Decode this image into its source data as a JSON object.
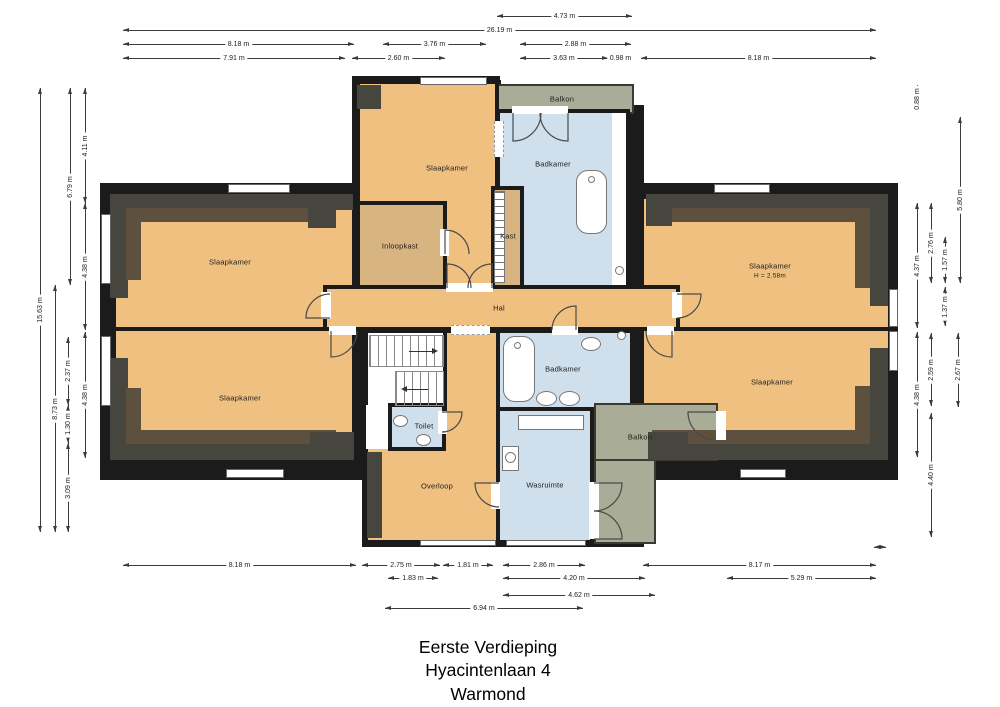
{
  "meta": {
    "width": 1000,
    "height": 707,
    "background": "#ffffff"
  },
  "title": {
    "line1": "Eerste Verdieping",
    "line2": "Hyacintenlaan 4",
    "line3": "Warmond"
  },
  "palette": {
    "wall": "#1b1b1b",
    "room": "#f0c080",
    "closet": "#d8b481",
    "wet": "#cfdfec",
    "balcony": "#a9ac97",
    "white": "#ffffff",
    "slope_dark": "#46463f",
    "slope_brown": "#5d503e",
    "dim_line": "#3c3c3c",
    "label": "#1d1d1d"
  },
  "walls": [
    {
      "x": 100,
      "y": 183,
      "w": 265,
      "h": 297
    },
    {
      "x": 352,
      "y": 76,
      "w": 148,
      "h": 110
    },
    {
      "x": 492,
      "y": 105,
      "w": 152,
      "h": 81
    },
    {
      "x": 488,
      "y": 76,
      "w": 12,
      "h": 34
    },
    {
      "x": 362,
      "y": 180,
      "w": 282,
      "h": 367
    },
    {
      "x": 636,
      "y": 183,
      "w": 262,
      "h": 297
    },
    {
      "x": 493,
      "y": 80,
      "w": 8,
      "h": 110
    },
    {
      "x": 606,
      "y": 235,
      "w": 7,
      "h": 52
    },
    {
      "x": 716,
      "y": 403,
      "w": 10,
      "h": 76
    }
  ],
  "rooms": [
    {
      "name": "balkon-top",
      "fill": "balcony",
      "x": 490,
      "y": 84,
      "w": 144,
      "h": 30,
      "border": "thin"
    },
    {
      "name": "slaapkamer-top-left",
      "fill": "room",
      "x": 112,
      "y": 195,
      "w": 244,
      "h": 136,
      "border": "thick"
    },
    {
      "name": "slaapkamer-bottom-left",
      "fill": "room",
      "x": 112,
      "y": 327,
      "w": 244,
      "h": 135,
      "border": "thick"
    },
    {
      "name": "slaapkamer-top-right",
      "fill": "room",
      "x": 640,
      "y": 195,
      "w": 252,
      "h": 136,
      "border": "thick"
    },
    {
      "name": "slaapkamer-bottom-right",
      "fill": "room",
      "x": 640,
      "y": 327,
      "w": 252,
      "h": 135,
      "border": "thick"
    },
    {
      "name": "slaapkamer-top-center",
      "fill": "room",
      "x": 356,
      "y": 80,
      "w": 143,
      "h": 211,
      "border": "thick"
    },
    {
      "name": "badkamer-top",
      "fill": "wet",
      "x": 496,
      "y": 109,
      "w": 134,
      "h": 182,
      "border": "thick"
    },
    {
      "name": "douche-strip",
      "fill": "white",
      "x": 612,
      "y": 113,
      "w": 14,
      "h": 174,
      "border": "none"
    },
    {
      "name": "inloopkast",
      "fill": "closet",
      "x": 356,
      "y": 201,
      "w": 91,
      "h": 90,
      "border": "thick"
    },
    {
      "name": "kast",
      "fill": "closet",
      "x": 491,
      "y": 186,
      "w": 33,
      "h": 105,
      "border": "thick"
    },
    {
      "name": "hal",
      "fill": "room",
      "x": 323,
      "y": 285,
      "w": 357,
      "h": 46,
      "border": "thick"
    },
    {
      "name": "overloop",
      "fill": "room",
      "x": 364,
      "y": 329,
      "w": 137,
      "h": 215,
      "border": "thick"
    },
    {
      "name": "stairwell",
      "fill": "white",
      "x": 364,
      "y": 329,
      "w": 83,
      "h": 82,
      "border": "thick"
    },
    {
      "name": "stair-landing",
      "fill": "white",
      "x": 366,
      "y": 405,
      "w": 24,
      "h": 44,
      "border": "none"
    },
    {
      "name": "toilet",
      "fill": "wet",
      "x": 388,
      "y": 403,
      "w": 58,
      "h": 48,
      "border": "thick"
    },
    {
      "name": "badkamer-bottom",
      "fill": "wet",
      "x": 496,
      "y": 329,
      "w": 138,
      "h": 86,
      "border": "thick"
    },
    {
      "name": "wasruimte",
      "fill": "wet",
      "x": 496,
      "y": 407,
      "w": 98,
      "h": 137,
      "border": "thick"
    },
    {
      "name": "balkon-bottom-vertical",
      "fill": "balcony",
      "x": 594,
      "y": 403,
      "w": 62,
      "h": 141,
      "border": "thin"
    },
    {
      "name": "balkon-bottom-horizontal",
      "fill": "balcony",
      "x": 594,
      "y": 403,
      "w": 124,
      "h": 58,
      "border": "thin"
    }
  ],
  "slopes": [
    {
      "x": 110,
      "y": 194,
      "w": 243,
      "h": 16,
      "tone": "dark"
    },
    {
      "x": 110,
      "y": 194,
      "w": 18,
      "h": 104,
      "tone": "dark"
    },
    {
      "x": 126,
      "y": 208,
      "w": 210,
      "h": 14,
      "tone": "brown"
    },
    {
      "x": 126,
      "y": 208,
      "w": 15,
      "h": 72,
      "tone": "brown"
    },
    {
      "x": 308,
      "y": 194,
      "w": 28,
      "h": 34,
      "tone": "dark"
    },
    {
      "x": 646,
      "y": 194,
      "w": 242,
      "h": 16,
      "tone": "dark"
    },
    {
      "x": 870,
      "y": 194,
      "w": 18,
      "h": 112,
      "tone": "dark"
    },
    {
      "x": 652,
      "y": 208,
      "w": 218,
      "h": 14,
      "tone": "brown"
    },
    {
      "x": 855,
      "y": 208,
      "w": 15,
      "h": 80,
      "tone": "brown"
    },
    {
      "x": 646,
      "y": 194,
      "w": 26,
      "h": 32,
      "tone": "dark"
    },
    {
      "x": 110,
      "y": 444,
      "w": 243,
      "h": 16,
      "tone": "dark"
    },
    {
      "x": 110,
      "y": 358,
      "w": 18,
      "h": 102,
      "tone": "dark"
    },
    {
      "x": 126,
      "y": 430,
      "w": 210,
      "h": 14,
      "tone": "brown"
    },
    {
      "x": 126,
      "y": 388,
      "w": 15,
      "h": 42,
      "tone": "brown"
    },
    {
      "x": 310,
      "y": 432,
      "w": 44,
      "h": 28,
      "tone": "dark"
    },
    {
      "x": 648,
      "y": 444,
      "w": 240,
      "h": 16,
      "tone": "dark"
    },
    {
      "x": 870,
      "y": 348,
      "w": 18,
      "h": 112,
      "tone": "dark"
    },
    {
      "x": 652,
      "y": 430,
      "w": 218,
      "h": 14,
      "tone": "brown"
    },
    {
      "x": 855,
      "y": 386,
      "w": 15,
      "h": 44,
      "tone": "brown"
    },
    {
      "x": 648,
      "y": 432,
      "w": 40,
      "h": 28,
      "tone": "dark"
    },
    {
      "x": 357,
      "y": 85,
      "w": 24,
      "h": 24,
      "tone": "dark"
    },
    {
      "x": 367,
      "y": 452,
      "w": 15,
      "h": 86,
      "tone": "dark"
    }
  ],
  "windows": [
    {
      "x": 228,
      "y": 184,
      "w": 62,
      "h": 9
    },
    {
      "x": 420,
      "y": 77,
      "w": 67,
      "h": 8
    },
    {
      "x": 714,
      "y": 184,
      "w": 56,
      "h": 9
    },
    {
      "x": 101,
      "y": 214,
      "w": 10,
      "h": 70
    },
    {
      "x": 101,
      "y": 336,
      "w": 10,
      "h": 70
    },
    {
      "x": 889,
      "y": 289,
      "w": 9,
      "h": 38
    },
    {
      "x": 889,
      "y": 331,
      "w": 9,
      "h": 40
    },
    {
      "x": 226,
      "y": 469,
      "w": 58,
      "h": 9
    },
    {
      "x": 740,
      "y": 469,
      "w": 46,
      "h": 9
    },
    {
      "x": 420,
      "y": 540,
      "w": 76,
      "h": 6
    },
    {
      "x": 506,
      "y": 540,
      "w": 80,
      "h": 6
    }
  ],
  "gaps": [
    {
      "x": 321,
      "y": 292,
      "w": 10,
      "h": 27
    },
    {
      "x": 329,
      "y": 326,
      "w": 27,
      "h": 9
    },
    {
      "x": 672,
      "y": 292,
      "w": 10,
      "h": 26
    },
    {
      "x": 647,
      "y": 326,
      "w": 27,
      "h": 9
    },
    {
      "x": 552,
      "y": 326,
      "w": 26,
      "h": 9
    },
    {
      "x": 438,
      "y": 411,
      "w": 9,
      "h": 23
    },
    {
      "x": 491,
      "y": 482,
      "w": 9,
      "h": 27
    },
    {
      "x": 716,
      "y": 411,
      "w": 10,
      "h": 29
    },
    {
      "x": 589,
      "y": 482,
      "w": 10,
      "h": 57
    },
    {
      "x": 440,
      "y": 229,
      "w": 9,
      "h": 27
    },
    {
      "x": 512,
      "y": 106,
      "w": 56,
      "h": 8
    },
    {
      "x": 446,
      "y": 283,
      "w": 47,
      "h": 9
    }
  ],
  "dashes": [
    {
      "x": 451,
      "y": 325,
      "w": 39,
      "h": 10,
      "o": "h"
    },
    {
      "x": 494,
      "y": 121,
      "w": 10,
      "h": 36,
      "o": "v"
    }
  ],
  "ladder": {
    "x": 494,
    "y": 191,
    "w": 11,
    "h": 92
  },
  "stairs": [
    {
      "x": 370,
      "y": 336,
      "w": 73,
      "h": 30,
      "dir": "right"
    },
    {
      "x": 396,
      "y": 372,
      "w": 47,
      "h": 33,
      "dir": "left"
    }
  ],
  "fixtures": [
    {
      "kind": "tub",
      "x": 576,
      "y": 170,
      "w": 31,
      "h": 64
    },
    {
      "kind": "circle",
      "x": 588,
      "y": 176,
      "w": 7,
      "h": 7
    },
    {
      "kind": "tub",
      "x": 503,
      "y": 336,
      "w": 32,
      "h": 66
    },
    {
      "kind": "circle",
      "x": 514,
      "y": 342,
      "w": 7,
      "h": 7
    },
    {
      "kind": "ellipse",
      "x": 536,
      "y": 391,
      "w": 21,
      "h": 15
    },
    {
      "kind": "ellipse",
      "x": 559,
      "y": 391,
      "w": 21,
      "h": 15
    },
    {
      "kind": "ellipse",
      "x": 581,
      "y": 337,
      "w": 20,
      "h": 14
    },
    {
      "kind": "ellipse",
      "x": 393,
      "y": 415,
      "w": 15,
      "h": 12
    },
    {
      "kind": "ellipse",
      "x": 416,
      "y": 434,
      "w": 15,
      "h": 12
    },
    {
      "kind": "circle",
      "x": 615,
      "y": 266,
      "w": 9,
      "h": 9
    },
    {
      "kind": "circle",
      "x": 617,
      "y": 331,
      "w": 9,
      "h": 9
    },
    {
      "kind": "rect",
      "x": 518,
      "y": 415,
      "w": 66,
      "h": 15
    },
    {
      "kind": "rect",
      "x": 502,
      "y": 446,
      "w": 17,
      "h": 25
    },
    {
      "kind": "circle",
      "x": 505,
      "y": 452,
      "w": 11,
      "h": 11
    }
  ],
  "doors": [
    {
      "path": "M513 113 L513 141 A28 28 0 0 0 541 113"
    },
    {
      "path": "M568 113 L568 141 A28 28 0 0 1 540 113"
    },
    {
      "path": "M447 288 L447 264 A24 24 0 0 1 471 288"
    },
    {
      "path": "M492 288 L492 264 A24 24 0 0 0 468 288"
    },
    {
      "path": "M330 318 L306 318 A24 24 0 0 1 330 294"
    },
    {
      "path": "M331 331 L331 357 A26 26 0 0 0 357 331"
    },
    {
      "path": "M677 294 L701 294 A24 24 0 0 1 677 318"
    },
    {
      "path": "M672 331 L672 357 A26 26 0 0 1 646 331"
    },
    {
      "path": "M576 330 L576 306 A24 24 0 0 0 552 330"
    },
    {
      "path": "M445 254 L445 230 A24 24 0 0 1 469 254"
    },
    {
      "path": "M442 412 L462 412 A20 20 0 0 1 442 432"
    },
    {
      "path": "M499 483 L475 483 A24 24 0 0 0 499 507"
    },
    {
      "path": "M716 412 L688 412 A28 28 0 0 0 716 440"
    },
    {
      "path": "M594 483 L622 483 A28 28 0 0 1 594 511"
    },
    {
      "path": "M594 539 L622 539 A28 28 0 0 0 594 511"
    }
  ],
  "labels": [
    {
      "t": "Slaapkamer",
      "x": 230,
      "y": 262
    },
    {
      "t": "Slaapkamer",
      "x": 240,
      "y": 398
    },
    {
      "t": "Slaapkamer",
      "x": 447,
      "y": 168
    },
    {
      "t": "Slaapkamer",
      "x": 770,
      "y": 266
    },
    {
      "t": "H = 2.58m",
      "x": 770,
      "y": 276,
      "s": true
    },
    {
      "t": "Slaapkamer",
      "x": 772,
      "y": 382
    },
    {
      "t": "Inloopkast",
      "x": 400,
      "y": 246
    },
    {
      "t": "Kast",
      "x": 508,
      "y": 236
    },
    {
      "t": "Badkamer",
      "x": 553,
      "y": 164
    },
    {
      "t": "Balkon",
      "x": 562,
      "y": 99
    },
    {
      "t": "Hal",
      "x": 499,
      "y": 308
    },
    {
      "t": "Toilet",
      "x": 424,
      "y": 426
    },
    {
      "t": "Overloop",
      "x": 437,
      "y": 486
    },
    {
      "t": "Badkamer",
      "x": 563,
      "y": 369
    },
    {
      "t": "Wasruimte",
      "x": 545,
      "y": 485
    },
    {
      "t": "Balkon",
      "x": 640,
      "y": 437
    }
  ],
  "dims": {
    "h": [
      {
        "y": 16,
        "x1": 497,
        "x2": 632,
        "t": "4.73 m"
      },
      {
        "y": 30,
        "x1": 123,
        "x2": 876,
        "t": "26.19 m"
      },
      {
        "y": 44,
        "x1": 123,
        "x2": 354,
        "t": "8.18 m"
      },
      {
        "y": 44,
        "x1": 383,
        "x2": 486,
        "t": "3.76 m"
      },
      {
        "y": 44,
        "x1": 520,
        "x2": 631,
        "t": "2.88 m"
      },
      {
        "y": 58,
        "x1": 123,
        "x2": 345,
        "t": "7.91 m"
      },
      {
        "y": 58,
        "x1": 352,
        "x2": 445,
        "t": "2.60 m"
      },
      {
        "y": 58,
        "x1": 520,
        "x2": 608,
        "t": "3.63 m"
      },
      {
        "y": 58,
        "x1": 608,
        "x2": 633,
        "t": "0.98 m"
      },
      {
        "y": 58,
        "x1": 641,
        "x2": 876,
        "t": "8.18 m"
      },
      {
        "y": 565,
        "x1": 123,
        "x2": 356,
        "t": "8.18 m"
      },
      {
        "y": 565,
        "x1": 362,
        "x2": 440,
        "t": "2.75 m"
      },
      {
        "y": 565,
        "x1": 443,
        "x2": 493,
        "t": "1.81 m"
      },
      {
        "y": 565,
        "x1": 503,
        "x2": 585,
        "t": "2.86 m"
      },
      {
        "y": 565,
        "x1": 643,
        "x2": 876,
        "t": "8.17 m"
      },
      {
        "y": 578,
        "x1": 388,
        "x2": 438,
        "t": "1.83 m"
      },
      {
        "y": 578,
        "x1": 503,
        "x2": 645,
        "t": "4.20 m"
      },
      {
        "y": 578,
        "x1": 727,
        "x2": 876,
        "t": "5.29 m"
      },
      {
        "y": 595,
        "x1": 503,
        "x2": 655,
        "t": "4.62 m"
      },
      {
        "y": 608,
        "x1": 385,
        "x2": 583,
        "t": "6.94 m"
      },
      {
        "y": 547,
        "x1": 874,
        "x2": 886,
        "t": ""
      }
    ],
    "v": [
      {
        "x": 40,
        "y1": 88,
        "y2": 532,
        "t": "15.63 m"
      },
      {
        "x": 55,
        "y1": 285,
        "y2": 532,
        "t": "8.73 m"
      },
      {
        "x": 70,
        "y1": 88,
        "y2": 285,
        "t": "6.79 m"
      },
      {
        "x": 68,
        "y1": 337,
        "y2": 405,
        "t": "2.37 m"
      },
      {
        "x": 68,
        "y1": 405,
        "y2": 443,
        "t": "1.30 m"
      },
      {
        "x": 68,
        "y1": 443,
        "y2": 532,
        "t": "3.09 m"
      },
      {
        "x": 85,
        "y1": 88,
        "y2": 203,
        "t": "4.11 m"
      },
      {
        "x": 85,
        "y1": 203,
        "y2": 330,
        "t": "4.38 m"
      },
      {
        "x": 85,
        "y1": 332,
        "y2": 458,
        "t": "4.38 m"
      },
      {
        "x": 917,
        "y1": 85,
        "y2": 112,
        "t": "0.88 m"
      },
      {
        "x": 960,
        "y1": 117,
        "y2": 283,
        "t": "5.80 m"
      },
      {
        "x": 917,
        "y1": 203,
        "y2": 328,
        "t": "4.37 m"
      },
      {
        "x": 931,
        "y1": 203,
        "y2": 283,
        "t": "2.76 m"
      },
      {
        "x": 945,
        "y1": 237,
        "y2": 283,
        "t": "1.57 m"
      },
      {
        "x": 945,
        "y1": 287,
        "y2": 326,
        "t": "1.37 m"
      },
      {
        "x": 917,
        "y1": 332,
        "y2": 457,
        "t": "4.38 m"
      },
      {
        "x": 931,
        "y1": 333,
        "y2": 406,
        "t": "2.59 m"
      },
      {
        "x": 958,
        "y1": 333,
        "y2": 407,
        "t": "2.67 m"
      },
      {
        "x": 931,
        "y1": 413,
        "y2": 537,
        "t": "4.40 m"
      }
    ]
  }
}
